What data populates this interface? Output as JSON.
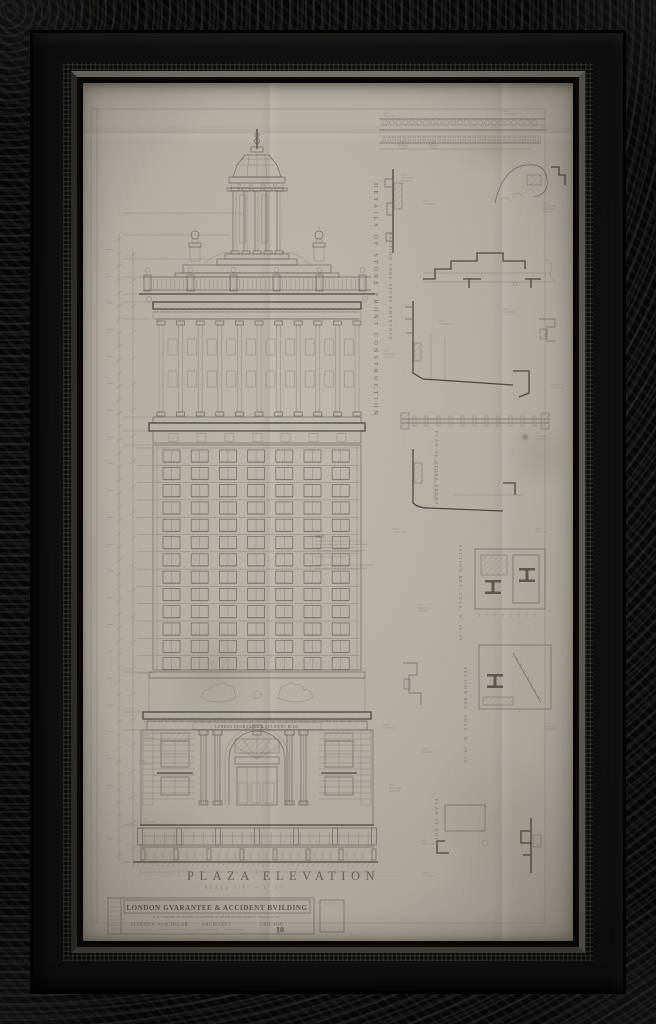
{
  "artwork": {
    "sheet_title": "PLAZA ELEVATION",
    "sheet_scale": "SCALE 1/8\" = 1'-0\"",
    "frieze_inscription": "LONDON GUARANTEE & ACCIDENT BLDG",
    "note_label": "NOTE:",
    "vertical_labels": [
      "DETAILS OF STORE FRONT CONSTRUCTION",
      "SECTION THRU STORE ENTRANCE",
      "PLAN OF STORE FRONT",
      "SECTION BET. COLS. Nº 28-29",
      "SECTION BET. COLS. Nº 29-30",
      "PLAN AT COL."
    ],
    "title_block": {
      "building_name": "LONDON GVARANTEE & ACCIDENT BVILDING",
      "location_line": "N.W. CORNER OF MICHIGAN AVENUE & SOUTH WATER STREET CHICAGO ILL.",
      "architect": "ALFRED S. ALSCHULER,",
      "architect_title": "ARCHITECT",
      "city": "CHICAGO",
      "sheet_number": "10"
    },
    "colors": {
      "paper": "#b4afa3",
      "ink": "#5d5d55",
      "ink_heavy": "#3d3d37",
      "frame": "#0b0b0b"
    },
    "drawing": {
      "shaft_floors": 13,
      "shaft_bays": 7,
      "colonnade_columns": 11,
      "storefront_piers": 7
    }
  }
}
